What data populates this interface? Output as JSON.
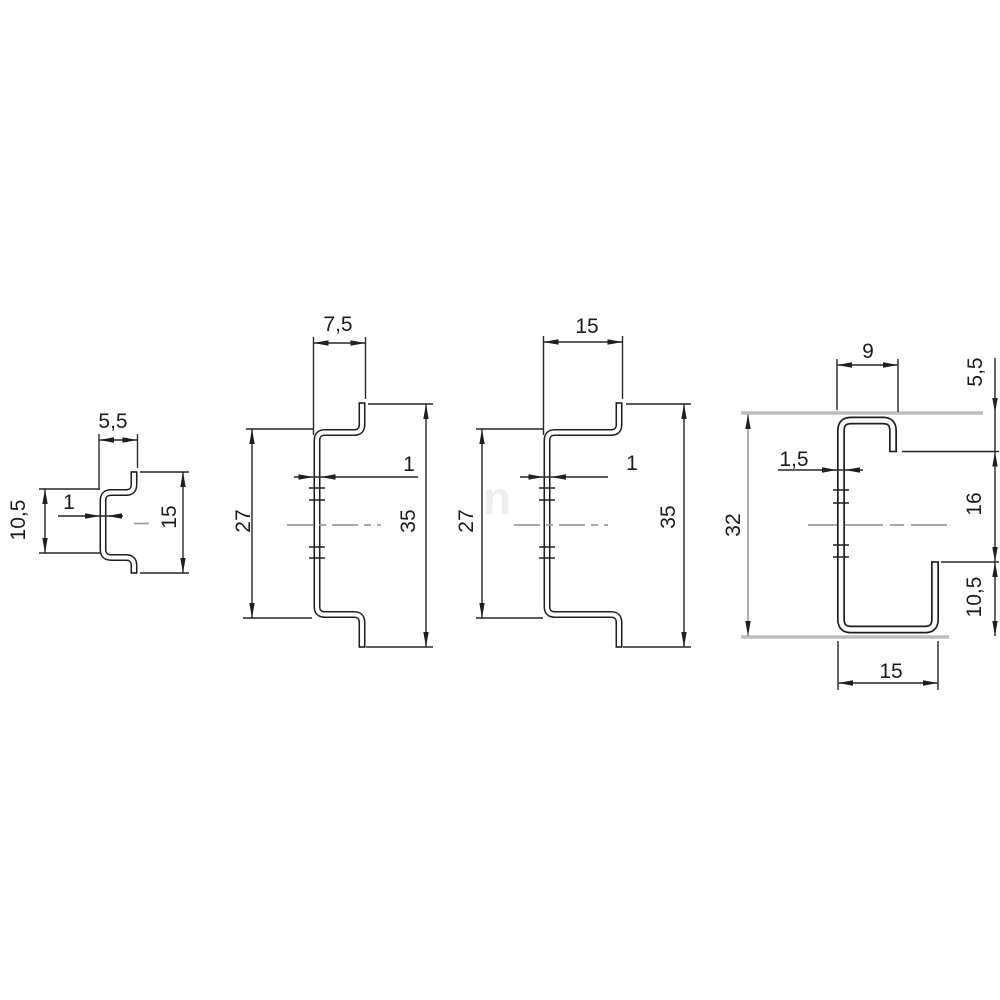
{
  "figure": {
    "description": "Engineering drawing: cross sections of four DIN mounting rail profiles with dimensions",
    "colors": {
      "line": "#1f1f1f",
      "dimension_line": "#262626",
      "gray_extension": "#bdbdbd",
      "centerline": "#9c9c9c",
      "background": "#ffffff"
    },
    "watermark": "n",
    "profiles": [
      {
        "id": "rail-profile-1",
        "labels": {
          "depth": "5,5",
          "inner_width": "10,5",
          "thickness": "1",
          "overall_width": "15"
        }
      },
      {
        "id": "rail-profile-2",
        "labels": {
          "depth": "7,5",
          "inner_width": "27",
          "thickness": "1",
          "overall_width": "35"
        }
      },
      {
        "id": "rail-profile-3",
        "labels": {
          "depth": "15",
          "inner_width": "27",
          "thickness": "1",
          "overall_width": "35"
        }
      },
      {
        "id": "rail-profile-4",
        "labels": {
          "top_depth": "9",
          "overall_width": "32",
          "thickness": "1,5",
          "top_edge": "5,5",
          "opening": "16",
          "bottom_edge": "10,5",
          "bottom_depth": "15"
        }
      }
    ]
  }
}
